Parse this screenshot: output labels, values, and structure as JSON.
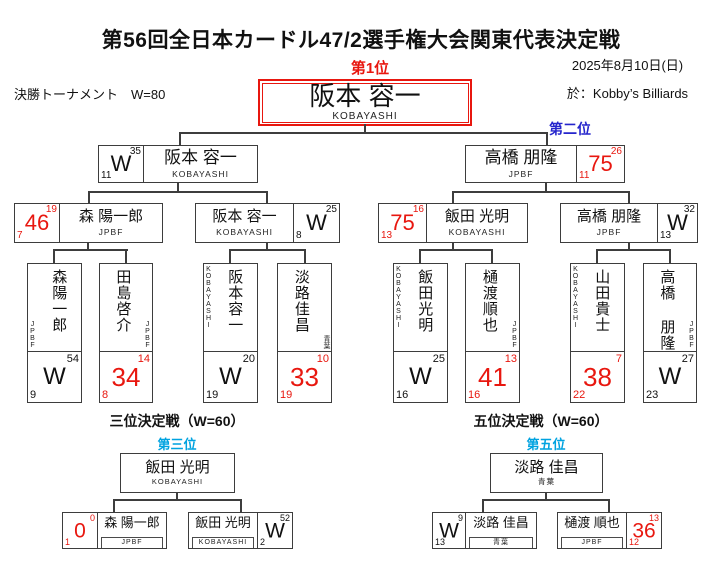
{
  "palette": {
    "accent_red": "#e8170f",
    "rank2_blue": "#2525cc",
    "rank35_skyblue": "#00a3e0",
    "line_color": "#3d3d3d"
  },
  "header": {
    "title": "第56回全日本カードル47/2選手権大会関東代表決定戦",
    "stage": "決勝トーナメント　W=80",
    "date": "2025年8月10日(日)",
    "venue": "於：Kobby’s Billiards"
  },
  "bracket": {
    "rank1_label": "第1位",
    "rank2_label": "第二位",
    "champion": {
      "name": "阪本 容一",
      "affiliation": "KOBAYASHI"
    },
    "final": [
      {
        "name": "阪本 容一",
        "affiliation": "KOBAYASHI",
        "score": "W",
        "top": "35",
        "bottom": "11"
      },
      {
        "name": "高橋 朋隆",
        "affiliation": "JPBF",
        "score": "75",
        "top": "26",
        "bottom": "11"
      }
    ],
    "semifinal": [
      {
        "name": "森 陽一郎",
        "affiliation": "JPBF",
        "score": "46",
        "top": "19",
        "bottom": "7"
      },
      {
        "name": "阪本 容一",
        "affiliation": "KOBAYASHI",
        "score": "W",
        "top": "25",
        "bottom": "8"
      },
      {
        "name": "飯田 光明",
        "affiliation": "KOBAYASHI",
        "score": "75",
        "top": "16",
        "bottom": "13"
      },
      {
        "name": "高橋 朋隆",
        "affiliation": "JPBF",
        "score": "W",
        "top": "32",
        "bottom": "13"
      }
    ],
    "quarterfinal": [
      {
        "name": "森陽一郎",
        "affiliation": "JPBF",
        "score": "W",
        "top": "54",
        "bottom": "9"
      },
      {
        "name": "田島啓介",
        "affiliation": "JPBF",
        "score": "34",
        "top": "14",
        "bottom": "8"
      },
      {
        "name": "阪本容一",
        "affiliation": "KOBAYASHI",
        "score": "W",
        "top": "20",
        "bottom": "19"
      },
      {
        "name": "淡路佳昌",
        "affiliation": "青葉",
        "score": "33",
        "top": "10",
        "bottom": "19"
      },
      {
        "name": "飯田光明",
        "affiliation": "KOBAYASHI",
        "score": "W",
        "top": "25",
        "bottom": "16"
      },
      {
        "name": "樋渡順也",
        "affiliation": "JPBF",
        "score": "41",
        "top": "13",
        "bottom": "16"
      },
      {
        "name": "山田貴士",
        "affiliation": "KOBAYASHI",
        "score": "38",
        "top": "7",
        "bottom": "22"
      },
      {
        "name": "高橋 朋隆",
        "affiliation": "JPBF",
        "score": "W",
        "top": "27",
        "bottom": "23"
      }
    ]
  },
  "third_place": {
    "title": "三位決定戦（W=60）",
    "rank_label": "第三位",
    "winner": {
      "name": "飯田 光明",
      "affiliation": "KOBAYASHI"
    },
    "players": [
      {
        "name": "森 陽一郎",
        "affiliation": "JPBF",
        "score": "0",
        "top": "0",
        "bottom": "1"
      },
      {
        "name": "飯田 光明",
        "affiliation": "KOBAYASHI",
        "score": "W",
        "top": "52",
        "bottom": "2"
      }
    ]
  },
  "fifth_place": {
    "title": "五位決定戦（W=60）",
    "rank_label": "第五位",
    "winner": {
      "name": "淡路 佳昌",
      "affiliation": "青葉"
    },
    "players": [
      {
        "name": "淡路 佳昌",
        "affiliation": "青葉",
        "score": "W",
        "top": "9",
        "bottom": "13"
      },
      {
        "name": "樋渡 順也",
        "affiliation": "JPBF",
        "score": "36",
        "top": "13",
        "bottom": "12"
      }
    ]
  }
}
